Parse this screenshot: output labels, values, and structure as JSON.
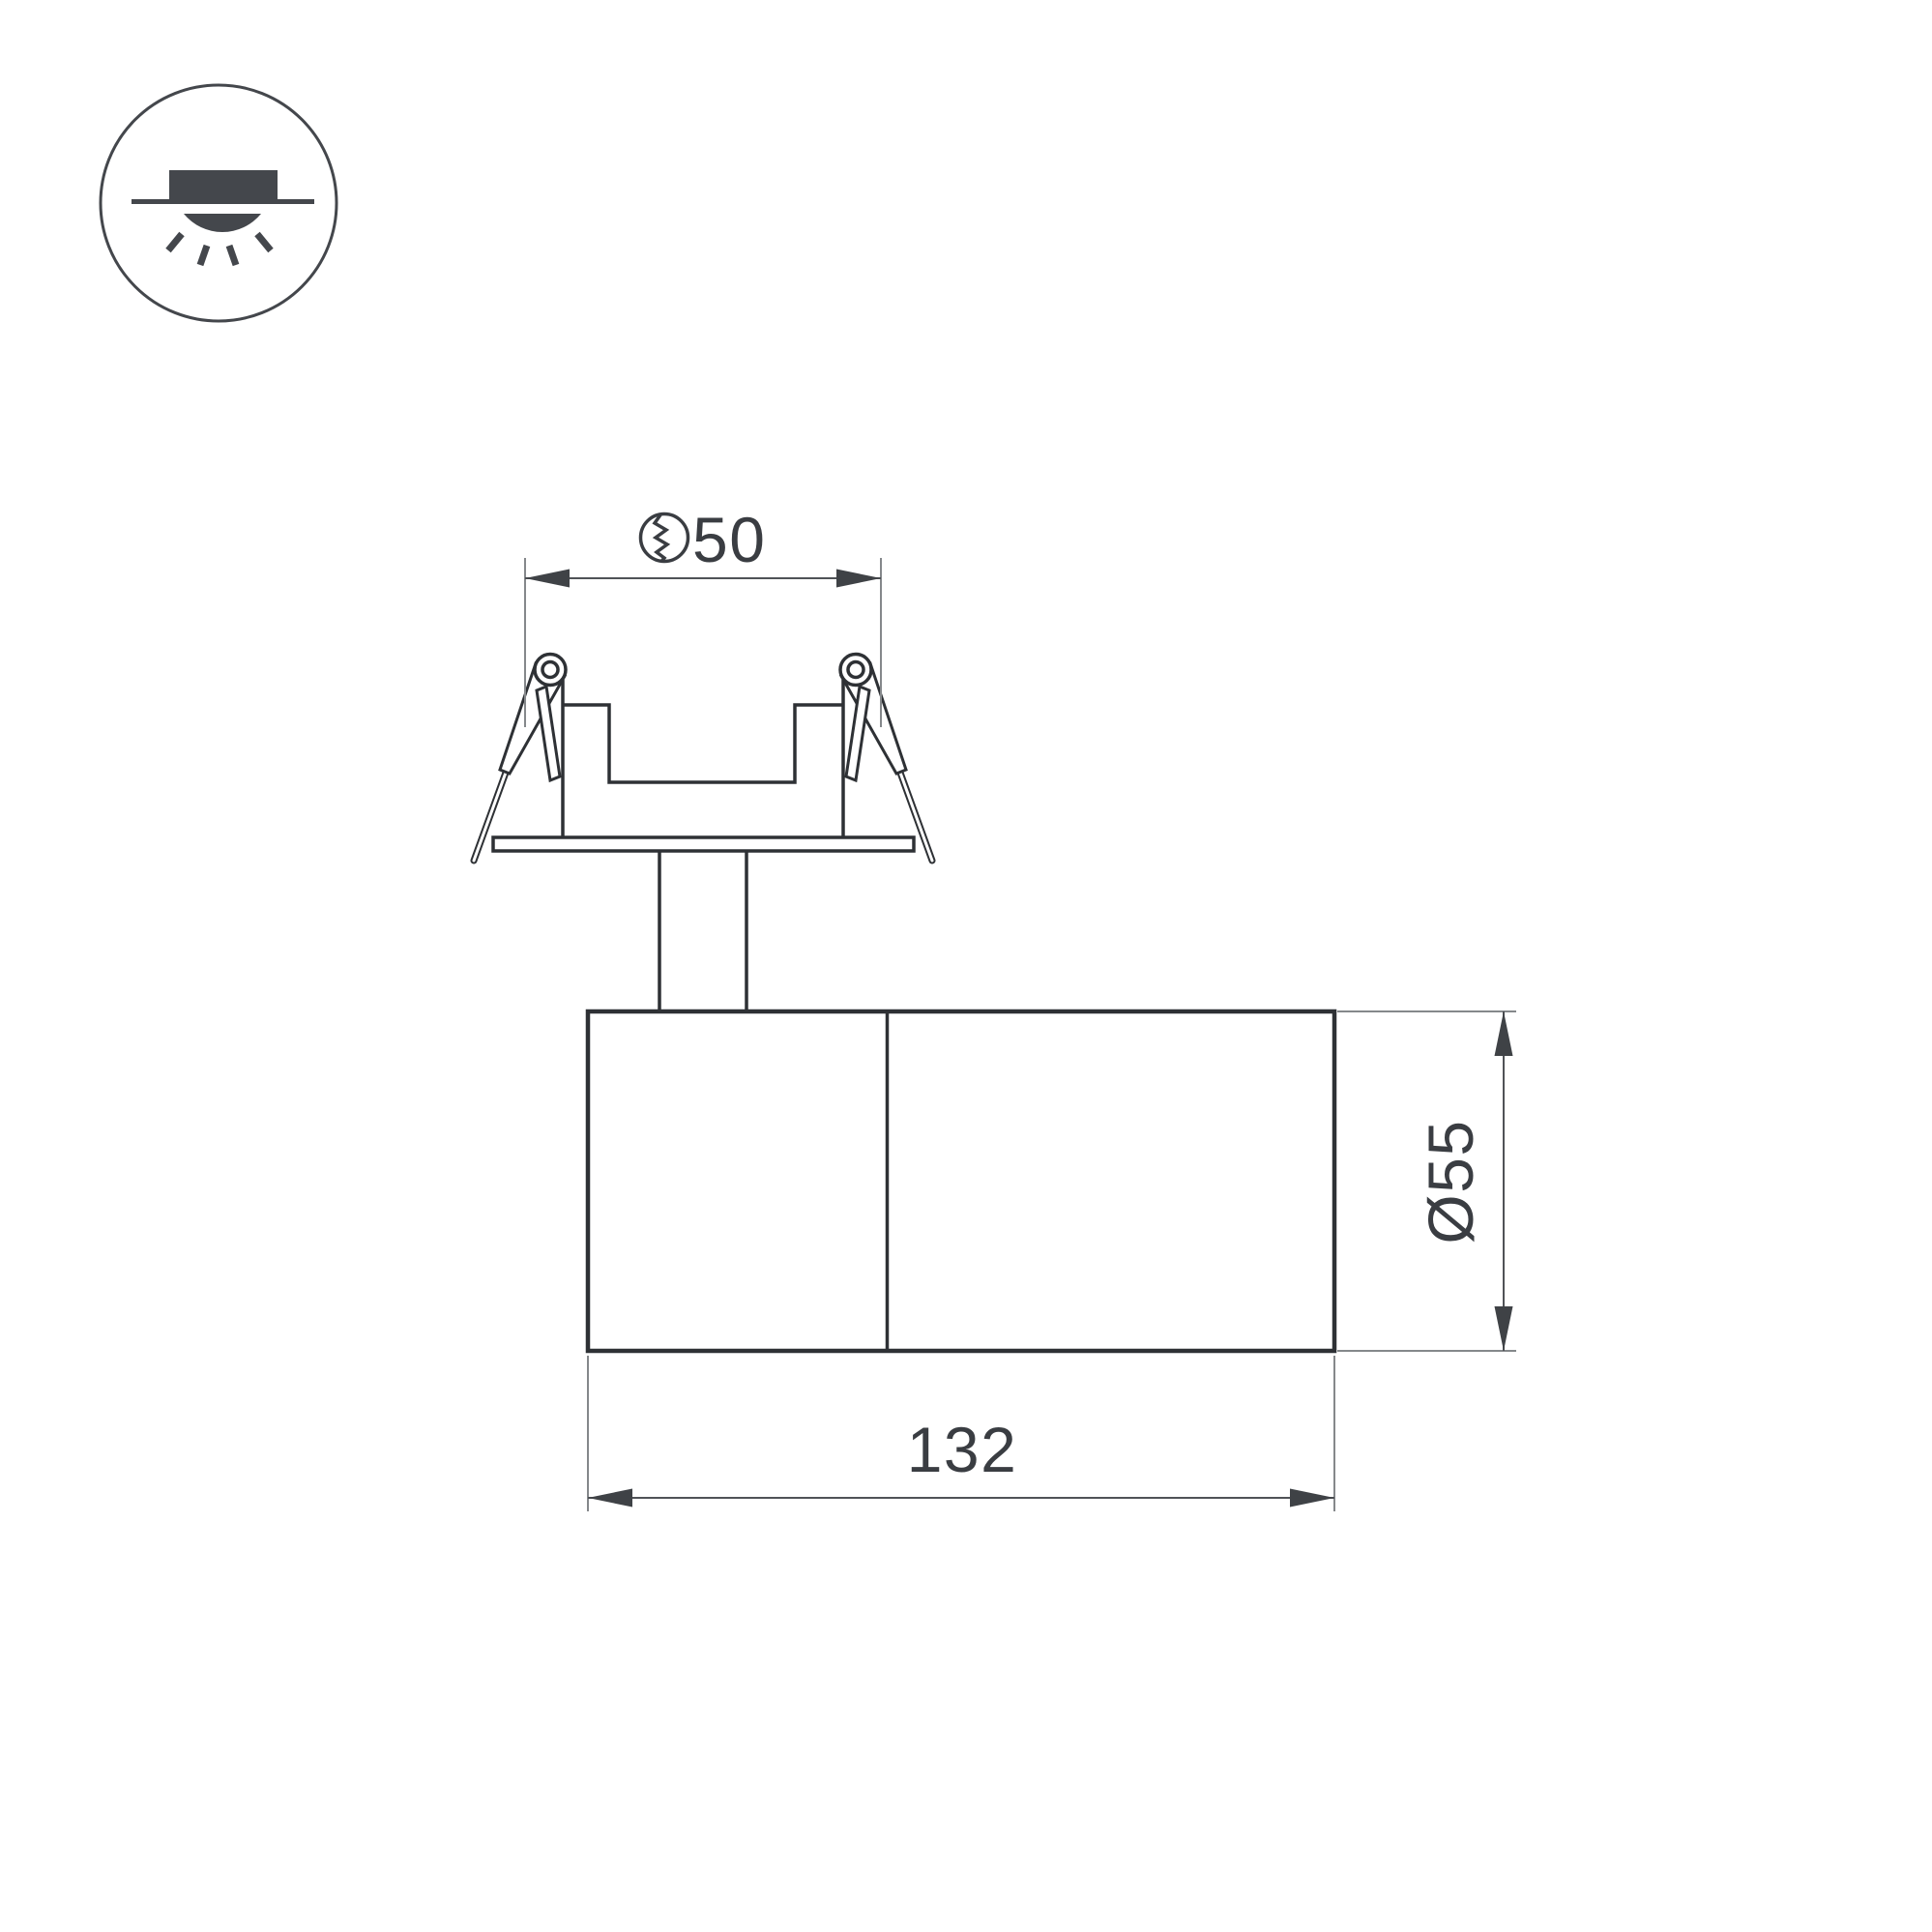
{
  "drawing": {
    "title": "recessed-spot-luminaire-dimension-drawing",
    "background": "#ffffff"
  },
  "colors": {
    "ink": "#2e3135",
    "icon": "#44474c",
    "ext": "#85888b",
    "dim": "#505357",
    "dim-dark": "#3f4246",
    "text": "#3a3d42"
  },
  "icon": {
    "name": "recessed-downlight-mounting-icon",
    "meaning": "recessed ceiling installation"
  },
  "dimensions": {
    "cutout": {
      "label": "50",
      "symbol": "ceiling-cutout-hole"
    },
    "diameter": {
      "label": "Ø55"
    },
    "length": {
      "label": "132"
    }
  }
}
